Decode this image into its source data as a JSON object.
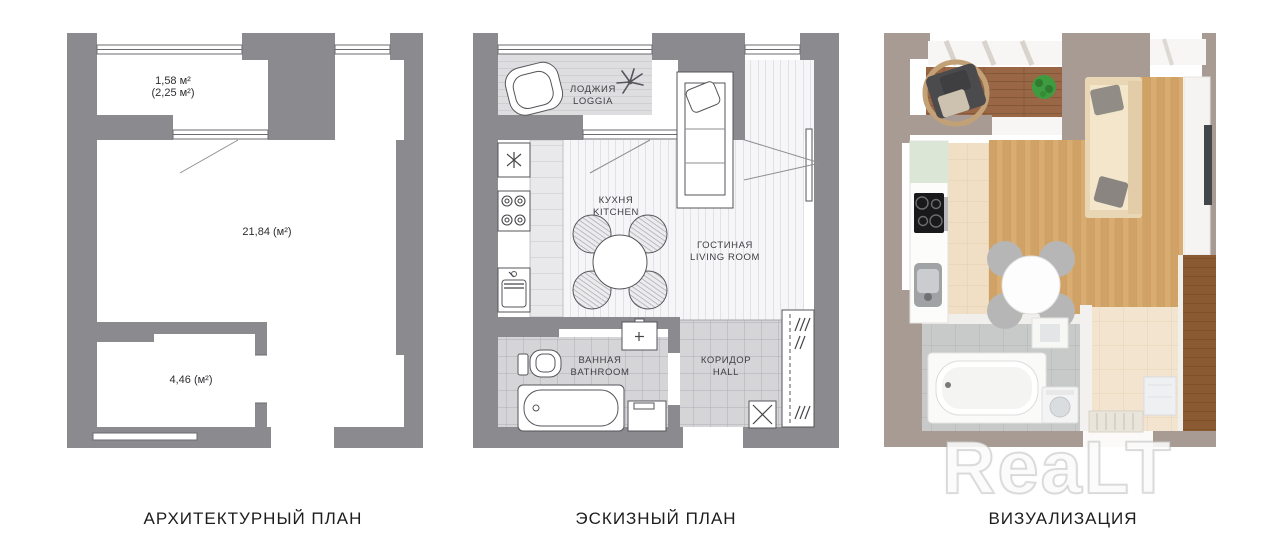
{
  "figure": {
    "watermark": "ReaLT",
    "colors": {
      "plan_wall_gray": "#8b8b8f",
      "render_wall_taupe": "#a89b93",
      "render_wood_floor": "#d9ad72",
      "render_deck_wood": "#9a6746",
      "caption_text": "#1d1d1d",
      "watermark_white": "#ffffff"
    }
  },
  "panels": {
    "architectural": {
      "caption": "АРХИТЕКТУРНЫЙ ПЛАН",
      "labels": {
        "balcony_area": "1,58 м²",
        "balcony_area_coeff": "(2,25 м²)",
        "main_room_area": "21,84 (м²)",
        "small_room_area": "4,46 (м²)"
      }
    },
    "sketch": {
      "caption": "ЭСКИЗНЫЙ ПЛАН",
      "rooms": {
        "loggia_ru": "ЛОДЖИЯ",
        "loggia_en": "LOGGIA",
        "kitchen_ru": "КУХНЯ",
        "kitchen_en": "KITCHEN",
        "living_ru": "ГОСТИНАЯ",
        "living_en": "LIVING ROOM",
        "bathroom_ru": "ВАННАЯ",
        "bathroom_en": "BATHROOM",
        "hall_ru": "КОРИДОР",
        "hall_en": "HALL"
      }
    },
    "visualization": {
      "caption": "ВИЗУАЛИЗАЦИЯ"
    }
  }
}
